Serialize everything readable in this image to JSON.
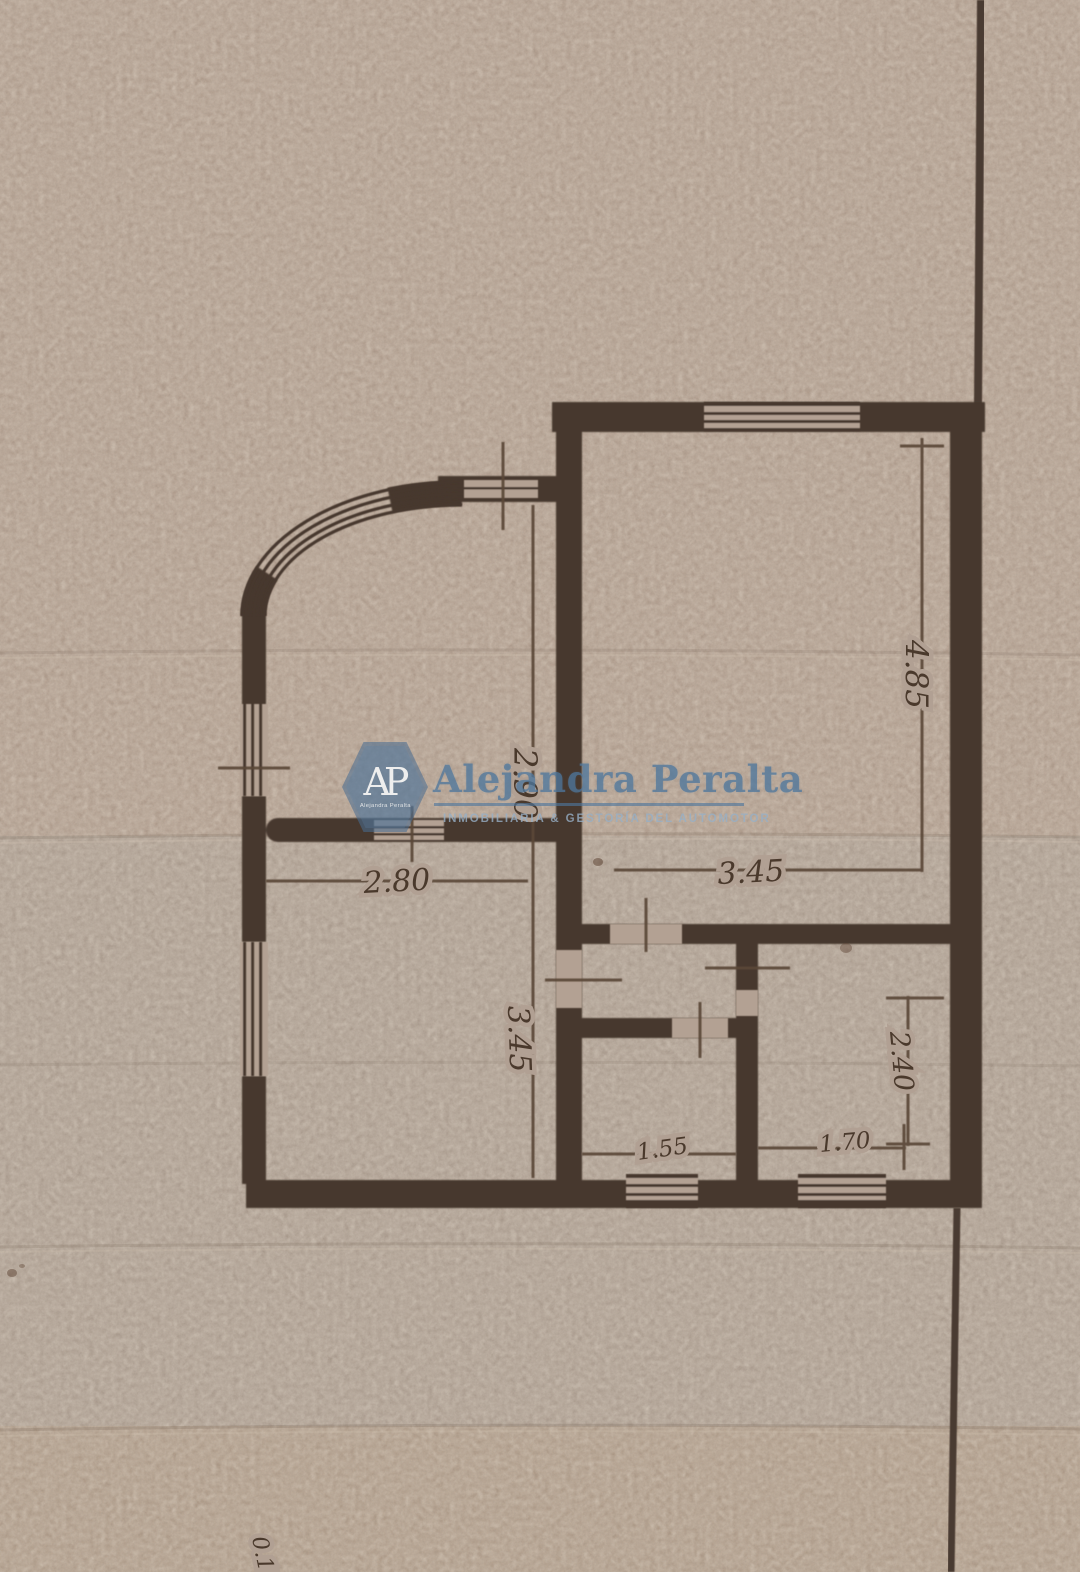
{
  "watermark": {
    "badge_initials": "AP",
    "badge_caption": "Alejandra Peralta",
    "title": "Alejandra Peralta",
    "subtitle": "INMOBILIARIA & GESTORÍA DEL AUTOMOTOR"
  },
  "dimensions": {
    "upper_left_room_height": "2.90",
    "right_room_height": "4.85",
    "lower_left_room_width": "2.80",
    "hall_width": "3.45",
    "lower_left_room_height": "3.45",
    "lower_right_room_height": "2.40",
    "bathroom_width": "1.55",
    "lower_right_room_width": "1.70",
    "edge_note": "0.15"
  },
  "colors": {
    "paper": "#b3a193",
    "wall_ink": "#46382e",
    "dimension_ink": "#5a4638",
    "watermark_blue": "#5b82a6"
  }
}
